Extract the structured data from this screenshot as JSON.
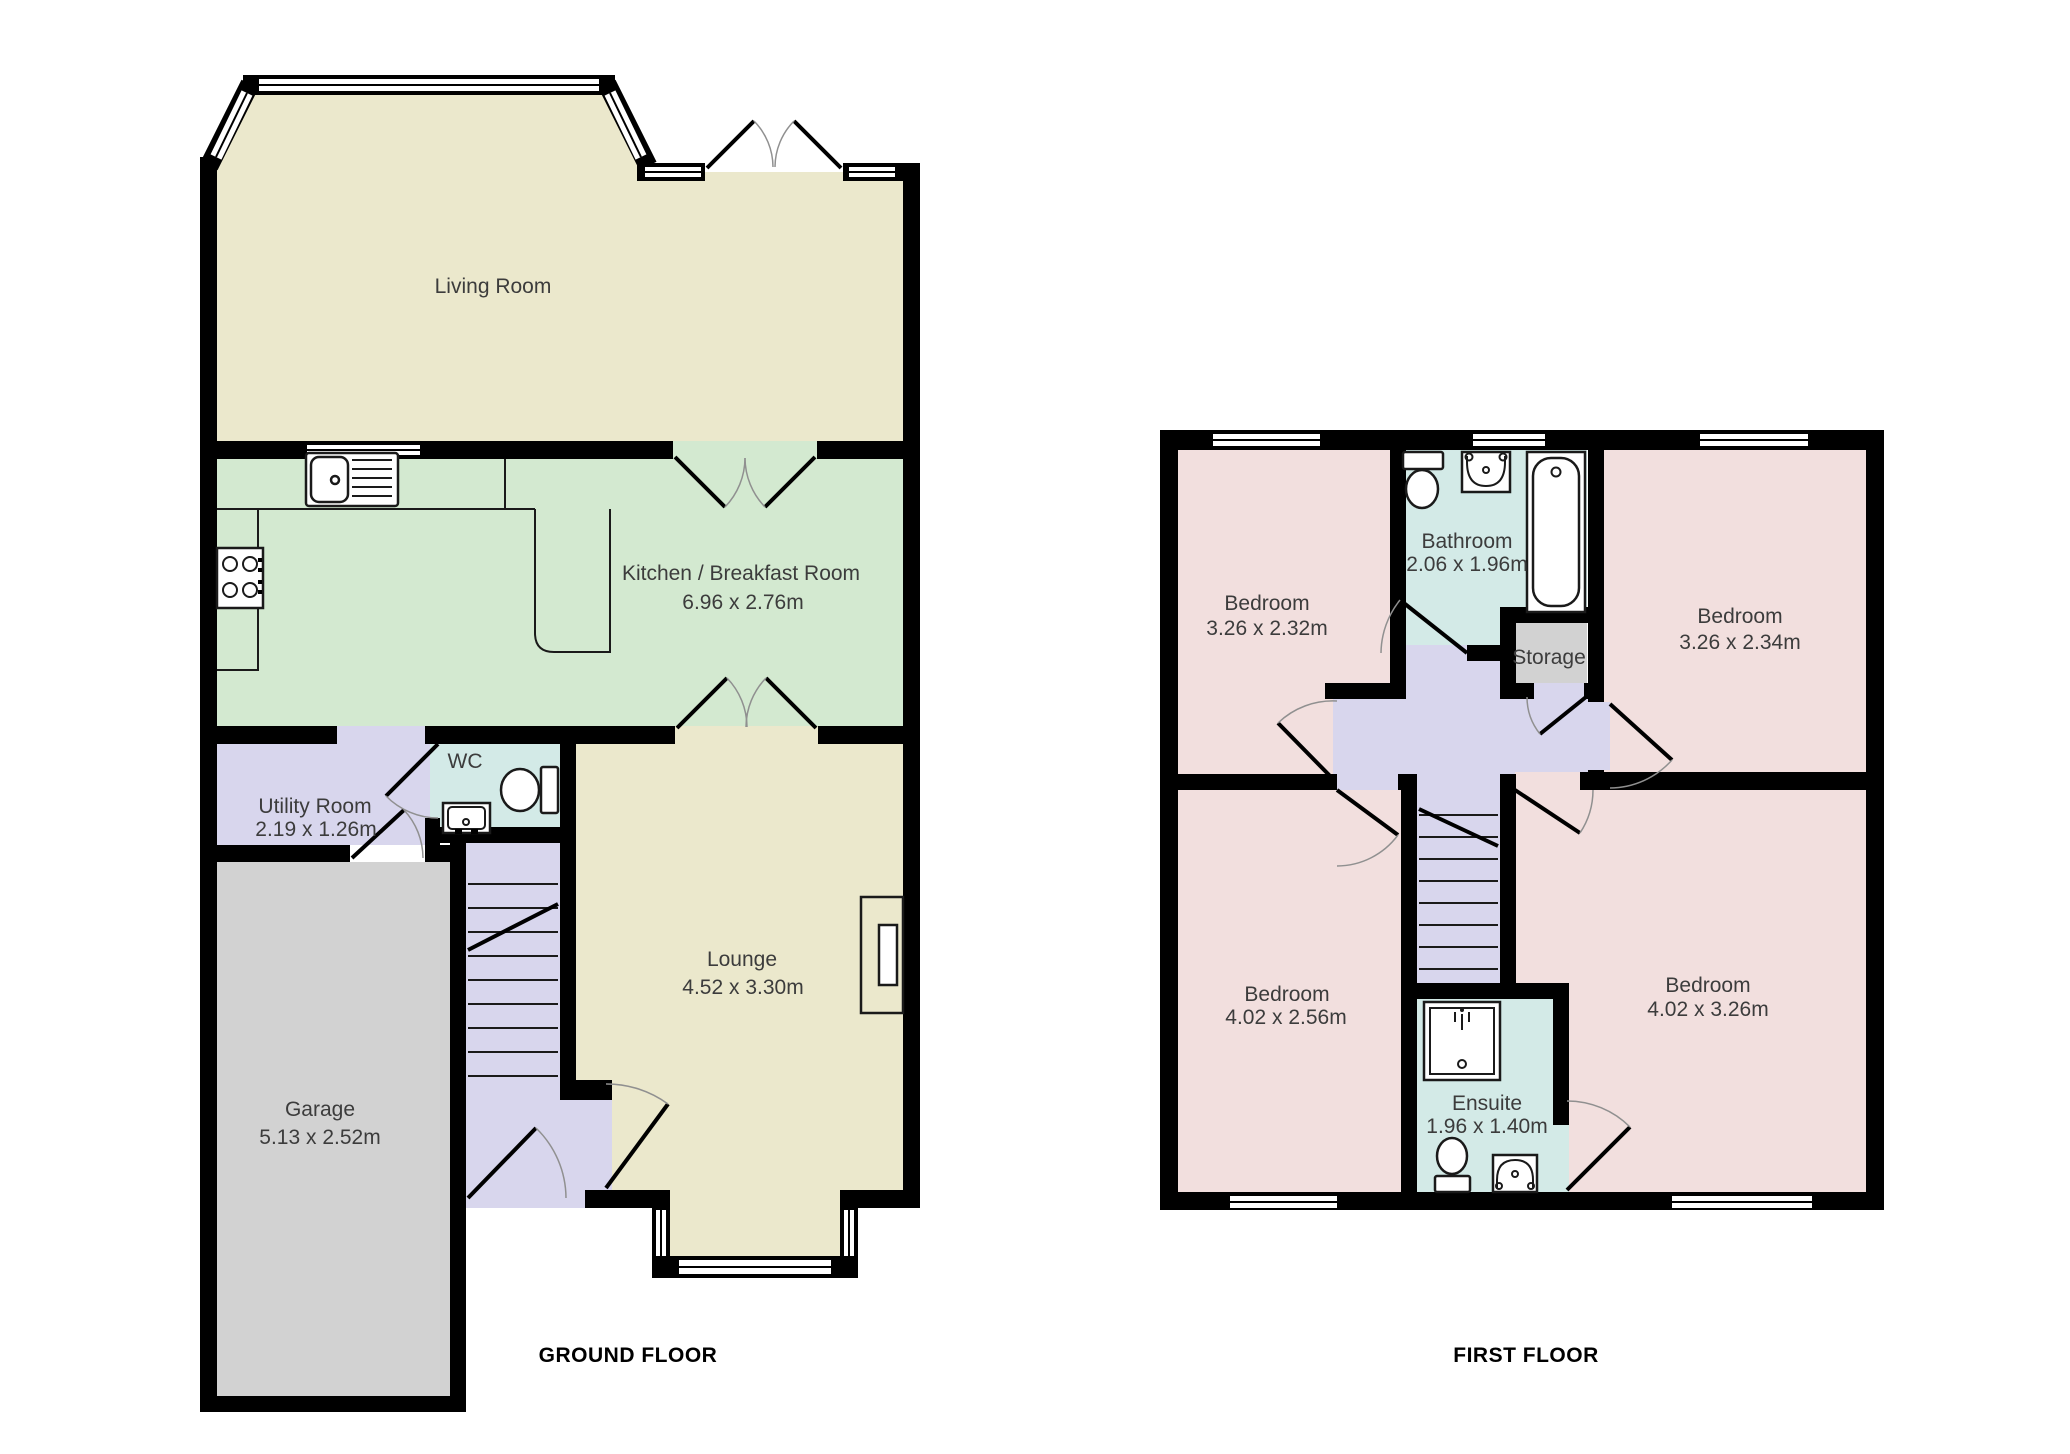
{
  "colors": {
    "wall": "#000000",
    "cream": "#EBE8CC",
    "green": "#D3E9D0",
    "lavender": "#D8D6ED",
    "teal": "#D3EAE7",
    "pink": "#F2DFDE",
    "gray": "#D2D2D2",
    "outline": "#1A1A1A",
    "arc": "#909090",
    "label": "#3C3C3C",
    "title": "#000000",
    "white": "#FFFFFF"
  },
  "ground_floor": {
    "title": "GROUND FLOOR",
    "rooms": {
      "living": {
        "name": "Living Room"
      },
      "kitchen": {
        "name": "Kitchen / Breakfast Room",
        "dims": "6.96 x 2.76m"
      },
      "utility": {
        "name": "Utility Room",
        "dims": "2.19 x 1.26m"
      },
      "wc": {
        "name": "WC"
      },
      "lounge": {
        "name": "Lounge",
        "dims": "4.52 x 3.30m"
      },
      "garage": {
        "name": "Garage",
        "dims": "5.13 x 2.52m"
      }
    }
  },
  "first_floor": {
    "title": "FIRST FLOOR",
    "rooms": {
      "bedroom_tl": {
        "name": "Bedroom",
        "dims": "3.26 x 2.32m"
      },
      "bathroom": {
        "name": "Bathroom",
        "dims": "2.06 x 1.96m"
      },
      "storage": {
        "name": "Storage"
      },
      "bedroom_tr": {
        "name": "Bedroom",
        "dims": "3.26 x 2.34m"
      },
      "bedroom_bl": {
        "name": "Bedroom",
        "dims": "4.02 x 2.56m"
      },
      "bedroom_br": {
        "name": "Bedroom",
        "dims": "4.02 x 3.26m"
      },
      "ensuite": {
        "name": "Ensuite",
        "dims": "1.96 x 1.40m"
      }
    }
  },
  "icons": [
    "kitchen-sink-icon",
    "hob-icon",
    "wc-toilet-icon",
    "wc-basin-icon",
    "fireplace-icon",
    "stairs-icon",
    "bath-icon",
    "bathroom-toilet-icon",
    "bathroom-basin-icon",
    "shower-icon",
    "ensuite-toilet-icon",
    "ensuite-basin-icon",
    "window-icon",
    "door-arc-icon"
  ]
}
